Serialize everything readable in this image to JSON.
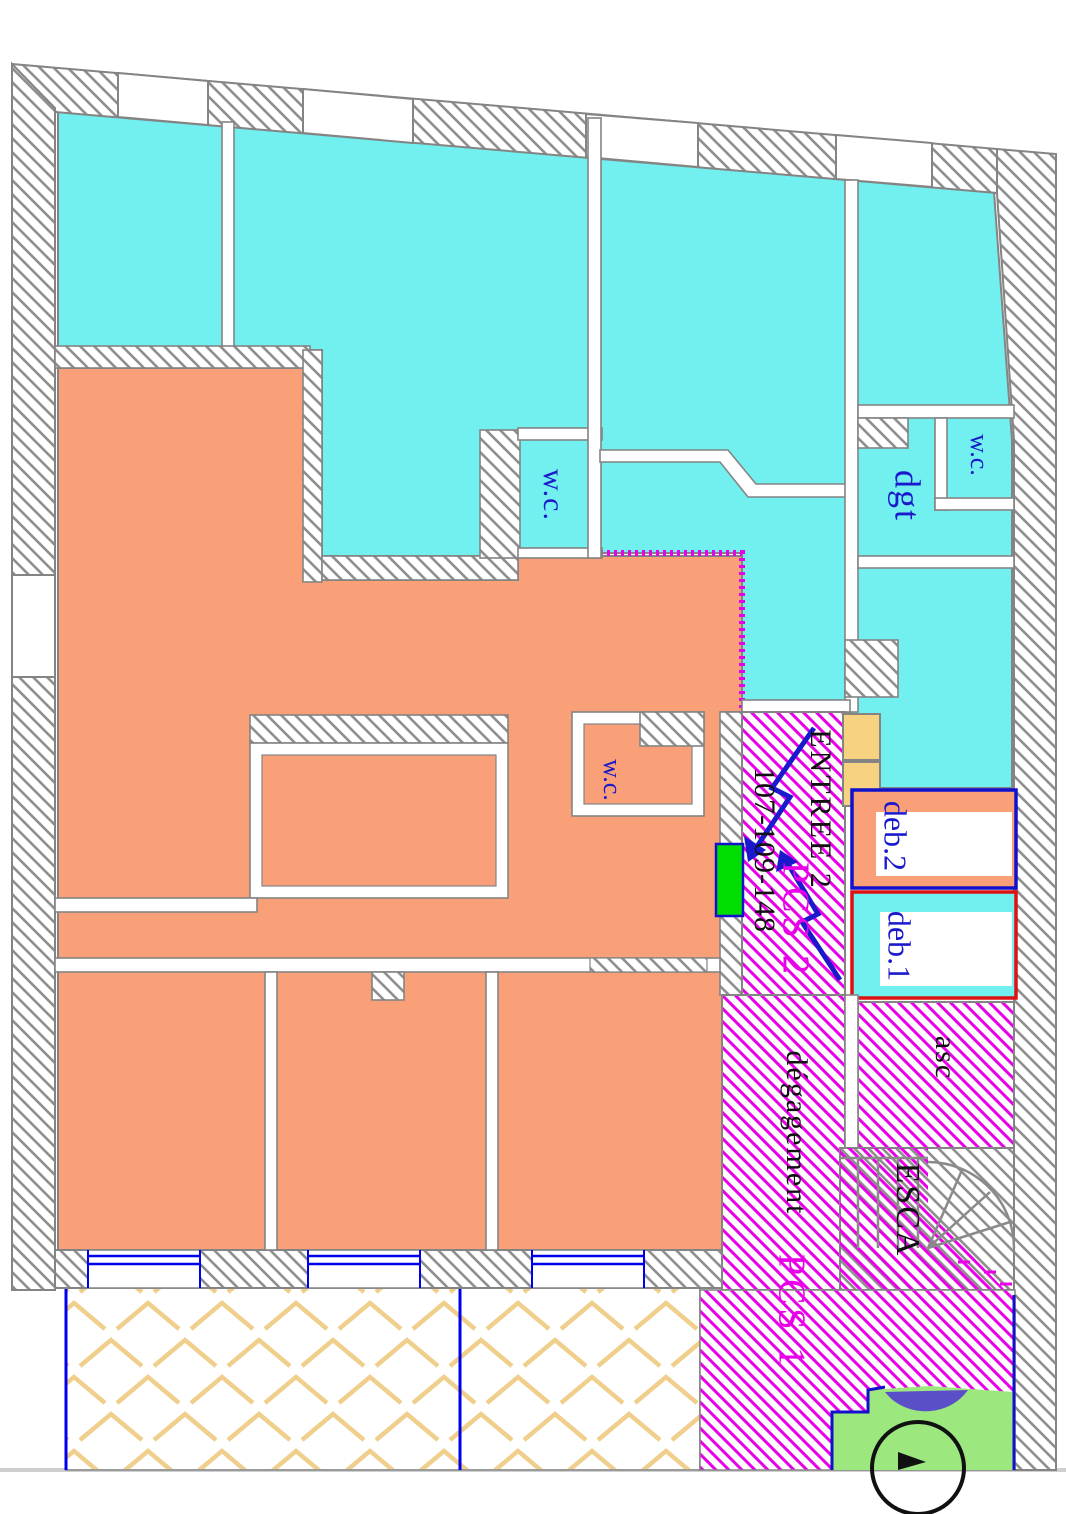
{
  "labels": {
    "wc_center": "w.c.",
    "wc_top_right": "w.c.",
    "wc_orange": "w.c.",
    "dgt": "dgt",
    "entree": "ENTREE 2",
    "lot_numbers": "107-109-148",
    "pcs2": "PCS 2",
    "deb2": "deb.2",
    "deb1": "deb.1",
    "asc": "asc",
    "degagement": "dégagement",
    "esca": "ESCA",
    "pcs1": "PCS 1"
  },
  "colors": {
    "cyan_zone": "#72efef",
    "orange_zone": "#f9a078",
    "wall_gray": "#848484",
    "hatch_gray": "#8f8f8f",
    "magenta_hatch": "#e800e8",
    "label_blue": "#1a1acc",
    "window_blue": "#0000ee",
    "deb1_border_red": "#dd1111",
    "deb2_border_blue": "#1111cc",
    "courtyard_chevron": "#efcf8b",
    "door_green": "#00dd00",
    "area_green": "#9ce87e",
    "blob_purple": "#5b4fc8",
    "door_block_yellow": "#f7d280"
  },
  "zones": [
    {
      "name": "cyan-apartment-zone",
      "fill": "#72efef"
    },
    {
      "name": "orange-apartment-zone",
      "fill": "#f9a078"
    },
    {
      "name": "entrance-corridor",
      "hatch": "#e800e8"
    },
    {
      "name": "degagement-corridor",
      "hatch": "#e800e8"
    },
    {
      "name": "pcs1-zone",
      "hatch": "#e800e8"
    },
    {
      "name": "elevator-asc",
      "hatch": "#e800e8"
    },
    {
      "name": "stair-esca",
      "hatch": "#8f8f8f"
    },
    {
      "name": "courtyard-chevron",
      "hatch": "#efcf8b"
    }
  ]
}
